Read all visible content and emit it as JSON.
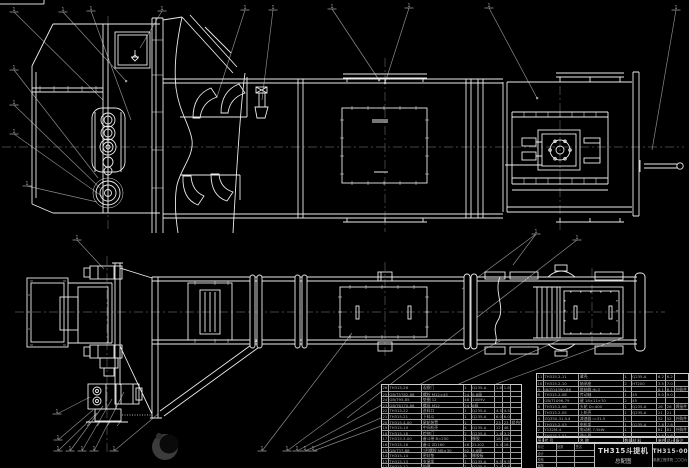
{
  "drawing": {
    "title": "TH315斗提机",
    "subtitle": "总配图",
    "drawing_no": "TH315-00",
    "org_line": "机械工程学院 二〇〇六",
    "colors": {
      "background": "#000000",
      "line": "#ebebeb",
      "leader": "#8a8a8a",
      "centerline": "#5a5a5a",
      "table_line": "#9f9f9f",
      "table_text": "#b2b2b2"
    },
    "callout_mark": "1"
  },
  "bom_left": {
    "rows": [
      [
        "26",
        "TH315-26",
        "观察门",
        "1",
        "Q235-A",
        "1.8",
        "1.8",
        ""
      ],
      [
        "25",
        "GB/T5782-86",
        "螺栓 M12×45",
        "24",
        "8.8级",
        "",
        "",
        ""
      ],
      [
        "24",
        "GB/T95-85",
        "垫圈 12",
        "48",
        "100HV",
        "",
        "",
        ""
      ],
      [
        "23",
        "GB/T6170-86",
        "螺母 M12",
        "24",
        "8级",
        "",
        "",
        ""
      ],
      [
        "22",
        "TH315-22",
        "进料口",
        "1",
        "Q235-A",
        "4.5",
        "4.5",
        ""
      ],
      [
        "21",
        "TH315-21",
        "下料斗",
        "1",
        "Q235-A",
        "6.0",
        "6.0",
        ""
      ],
      [
        "20",
        "TH315.4-00",
        "尾轮装置",
        "1",
        "",
        "23",
        "23",
        "组合件"
      ],
      [
        "19",
        "TH315-19",
        "中间机壳",
        "4",
        "Q235-A",
        "12",
        "48",
        ""
      ],
      [
        "18",
        "TH315-18",
        "检修门",
        "2",
        "Q235-A",
        "1.6",
        "3.2",
        ""
      ],
      [
        "17",
        "TH315.3-00",
        "畚斗带 B=250",
        "1",
        "橡胶",
        "18",
        "18",
        ""
      ],
      [
        "16",
        "TH315-16",
        "畚斗 ZD160",
        "46",
        "ZL102",
        "0.4",
        "18.4",
        ""
      ],
      [
        "15",
        "GB/T37-88",
        "T形螺栓 M8×30",
        "92",
        "4.8级",
        "",
        "",
        ""
      ],
      [
        "14",
        "TH315-14",
        "密封垫",
        "8",
        "橡胶板",
        "",
        "",
        ""
      ],
      [
        "13",
        "TH315-13",
        "支承架",
        "1",
        "Q235-A",
        "9.5",
        "9.5",
        ""
      ],
      [
        "12",
        "TH315-12",
        "护罩",
        "1",
        "Q235-A",
        "2.4",
        "2.4",
        ""
      ]
    ]
  },
  "bom_right": {
    "rows": [
      [
        "11",
        "TH315.2-11",
        "罩壳",
        "1",
        "Q235-A",
        "6.2",
        "6.2",
        ""
      ],
      [
        "10",
        "TH315.2-10",
        "轴承座",
        "2",
        "HT200",
        "3.5",
        "7.0",
        ""
      ],
      [
        "9",
        "JB/ZQ4390-86",
        "联轴器 HL3",
        "1",
        "",
        "8.1",
        "8.1",
        "外购件"
      ],
      [
        "8",
        "TH315.2-08",
        "传动轴",
        "1",
        "45",
        "9.0",
        "9.0",
        ""
      ],
      [
        "7",
        "GB/T1096-79",
        "键 18×11×70",
        "2",
        "45",
        "",
        "",
        ""
      ],
      [
        "6",
        "TH315.2-06",
        "头轮 D=400",
        "1",
        "Q235-A",
        "26",
        "26",
        "焊接件"
      ],
      [
        "5",
        "TH315.2-05",
        "上机壳",
        "1",
        "Q235-A",
        "21",
        "21",
        ""
      ],
      [
        "4",
        "ZQ350-31.5-Ⅱ",
        "减速器 i=31.5",
        "1",
        "",
        "52",
        "52",
        "外购件"
      ],
      [
        "3",
        "TH315.2-03",
        "电机架",
        "1",
        "Q235-A",
        "7.8",
        "7.8",
        ""
      ],
      [
        "2",
        "Y132M-4",
        "电动机 7.5kW",
        "1",
        "",
        "81",
        "81",
        "外购件"
      ],
      [
        "1",
        "TH315.2-01",
        "逆止器",
        "1",
        "",
        "2.6",
        "2.6",
        ""
      ]
    ],
    "headers_row": [
      [
        "序号",
        "代  号",
        "名  称",
        "数量",
        "材  料",
        "单件",
        "总计",
        "备注"
      ]
    ]
  },
  "title_block": {
    "left_rows": [
      [
        "标记",
        "处数",
        "签名"
      ],
      [
        "设计",
        "",
        ""
      ],
      [
        "校核",
        "",
        ""
      ],
      [
        "审核",
        "",
        ""
      ]
    ]
  }
}
